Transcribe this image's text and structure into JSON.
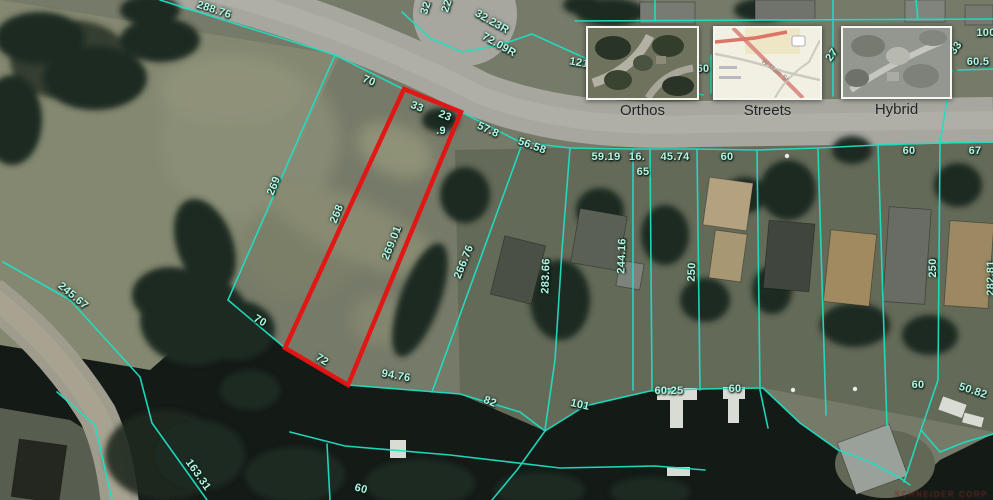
{
  "map_controls": {
    "base_layers": [
      {
        "label": "Orthos"
      },
      {
        "label": "Streets"
      },
      {
        "label": "Hybrid"
      }
    ],
    "streets_thumbnail_road_label": "W Main St"
  },
  "watermark": "SCHNEIDER CORP",
  "overlay": {
    "line_color": "#1fdfc2",
    "line_width": 1.6,
    "selected_parcel": {
      "color": "#e41414",
      "points": "404,89 461,112 348,385 285,348"
    },
    "boundary_lines": [
      {
        "points": "160,0 335,55"
      },
      {
        "points": "335,55 405,90"
      },
      {
        "points": "461,112 520,142 570,148 633,149 697,149 757,150 818,148 878,145 940,143 993,142"
      },
      {
        "points": "335,55 228,300"
      },
      {
        "points": "228,300 285,348"
      },
      {
        "points": "348,385 398,389 460,394 520,412 545,431 585,406 650,391 700,389 763,388"
      },
      {
        "points": "763,388 800,423 838,450 870,462 900,478 910,485"
      },
      {
        "points": "522,144 432,392"
      },
      {
        "points": "570,148 562,250 555,360 545,430"
      },
      {
        "points": "633,149 633,390"
      },
      {
        "points": "650,149 652,390"
      },
      {
        "points": "697,149 700,390"
      },
      {
        "points": "757,150 760,390 768,428"
      },
      {
        "points": "818,148 826,415"
      },
      {
        "points": "878,145 887,427"
      },
      {
        "points": "940,143 938,380 921,430 904,482"
      },
      {
        "points": "921,430 940,452 965,442 993,434"
      },
      {
        "points": "575,21 993,19"
      },
      {
        "points": "655,0 655,21"
      },
      {
        "points": "833,0 833,96"
      },
      {
        "points": "711,55 711,93"
      },
      {
        "points": "952,70 940,143"
      },
      {
        "points": "958,70 993,69"
      },
      {
        "points": "916,0 918,20"
      },
      {
        "points": "402,12 430,38 462,52 500,45 532,34"
      },
      {
        "points": "532,34 585,58 640,83 703,95"
      },
      {
        "points": "3,262 70,300 140,377 152,423 207,500"
      },
      {
        "points": "57,392 95,425 112,500"
      },
      {
        "points": "290,432 345,446 450,455 560,468 655,466 705,470"
      },
      {
        "points": "327,444 330,500"
      },
      {
        "points": "545,431 517,470 492,500"
      }
    ],
    "labels": [
      {
        "t": "288.76",
        "x": 214,
        "y": 10,
        "r": 18
      },
      {
        "t": "32",
        "x": 426,
        "y": 8,
        "r": -72
      },
      {
        "t": "22",
        "x": 447,
        "y": 6,
        "r": -72
      },
      {
        "t": "32.23R",
        "x": 492,
        "y": 22,
        "r": 30
      },
      {
        "t": "72.09R",
        "x": 499,
        "y": 45,
        "r": 30
      },
      {
        "t": "121",
        "x": 579,
        "y": 63,
        "r": 10
      },
      {
        "t": "70",
        "x": 369,
        "y": 81,
        "r": 22
      },
      {
        "t": "33",
        "x": 417,
        "y": 107,
        "r": 22
      },
      {
        "t": "23",
        "x": 445,
        "y": 116,
        "r": 22
      },
      {
        "t": ".9",
        "x": 441,
        "y": 131,
        "r": 0
      },
      {
        "t": "57.8",
        "x": 488,
        "y": 130,
        "r": 24
      },
      {
        "t": "56.58",
        "x": 532,
        "y": 146,
        "r": 20
      },
      {
        "t": "59.19",
        "x": 606,
        "y": 157,
        "r": 0
      },
      {
        "t": "16.",
        "x": 637,
        "y": 157,
        "r": 0
      },
      {
        "t": "65",
        "x": 643,
        "y": 172,
        "r": 0
      },
      {
        "t": "45.74",
        "x": 675,
        "y": 157,
        "r": 0
      },
      {
        "t": "60",
        "x": 727,
        "y": 157,
        "r": 0
      },
      {
        "t": "60",
        "x": 909,
        "y": 151,
        "r": 0
      },
      {
        "t": "67",
        "x": 975,
        "y": 151,
        "r": 0
      },
      {
        "t": "27",
        "x": 832,
        "y": 55,
        "r": -55
      },
      {
        "t": "60",
        "x": 703,
        "y": 69,
        "r": 0
      },
      {
        "t": "100",
        "x": 986,
        "y": 33,
        "r": 0
      },
      {
        "t": "60.5",
        "x": 978,
        "y": 62,
        "r": 0
      },
      {
        "t": "33",
        "x": 956,
        "y": 48,
        "r": -55
      },
      {
        "t": "269",
        "x": 274,
        "y": 186,
        "r": -68
      },
      {
        "t": "268",
        "x": 337,
        "y": 214,
        "r": -68
      },
      {
        "t": "269.01",
        "x": 392,
        "y": 243,
        "r": -68
      },
      {
        "t": "266.76",
        "x": 464,
        "y": 262,
        "r": -68
      },
      {
        "t": "283.66",
        "x": 546,
        "y": 276,
        "r": -88
      },
      {
        "t": "244.16",
        "x": 622,
        "y": 256,
        "r": -88
      },
      {
        "t": "250",
        "x": 692,
        "y": 272,
        "r": -88
      },
      {
        "t": "250",
        "x": 933,
        "y": 268,
        "r": -90
      },
      {
        "t": "282.81",
        "x": 991,
        "y": 278,
        "r": -90
      },
      {
        "t": "245.67",
        "x": 73,
        "y": 296,
        "r": 40
      },
      {
        "t": "70",
        "x": 260,
        "y": 321,
        "r": 30
      },
      {
        "t": "72",
        "x": 322,
        "y": 360,
        "r": 32
      },
      {
        "t": "94.76",
        "x": 396,
        "y": 376,
        "r": 10
      },
      {
        "t": "82",
        "x": 490,
        "y": 402,
        "r": 22
      },
      {
        "t": "101",
        "x": 580,
        "y": 405,
        "r": 12
      },
      {
        "t": "60.25",
        "x": 669,
        "y": 391,
        "r": 0
      },
      {
        "t": "60",
        "x": 735,
        "y": 389,
        "r": 0
      },
      {
        "t": "60",
        "x": 918,
        "y": 385,
        "r": 0
      },
      {
        "t": "50.82",
        "x": 973,
        "y": 391,
        "r": 18
      },
      {
        "t": "163.31",
        "x": 198,
        "y": 475,
        "r": 55
      },
      {
        "t": "60",
        "x": 361,
        "y": 489,
        "r": 15
      }
    ]
  }
}
